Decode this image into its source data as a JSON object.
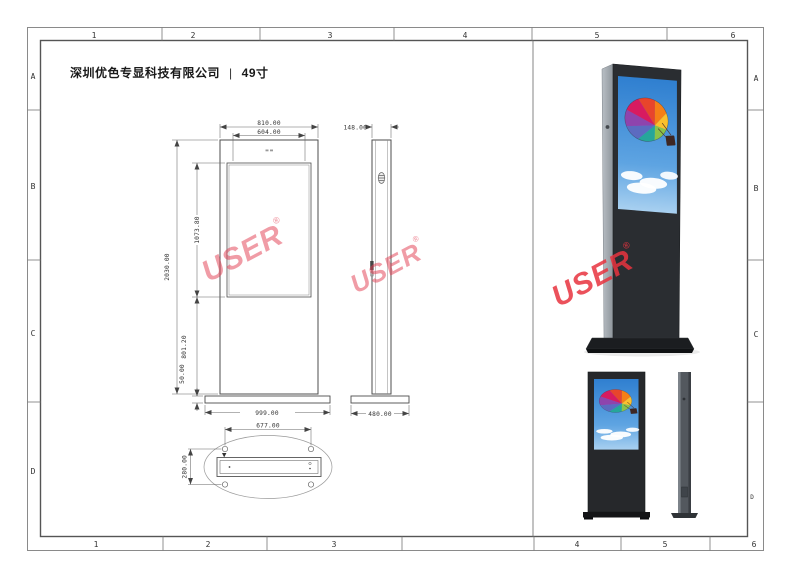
{
  "doc": {
    "company": "深圳优色专显科技有限公司",
    "divider": "|",
    "model": "49寸"
  },
  "grid": {
    "top": [
      "1",
      "2",
      "3",
      "4",
      "5",
      "6"
    ],
    "bottom": [
      "1",
      "2",
      "3",
      "4",
      "5",
      "6"
    ],
    "left": [
      "A",
      "B",
      "C",
      "D"
    ],
    "right": [
      "A",
      "B",
      "C",
      "D"
    ]
  },
  "watermark": {
    "text": "USER",
    "registered": "®",
    "color": "#e23b50"
  },
  "views": {
    "front": {
      "dims": {
        "outer_width": "810.00",
        "screen_width": "604.00",
        "total_height": "2030.00",
        "screen_height": "1073.80",
        "lower_section": "801.20",
        "base_plate": "50.00",
        "base_width": "999.00"
      }
    },
    "side": {
      "dims": {
        "depth": "148.00",
        "base_depth": "480.00"
      }
    },
    "bottom": {
      "dims": {
        "bolt_span": "677.00",
        "bolt_depth": "280.00"
      }
    }
  }
}
